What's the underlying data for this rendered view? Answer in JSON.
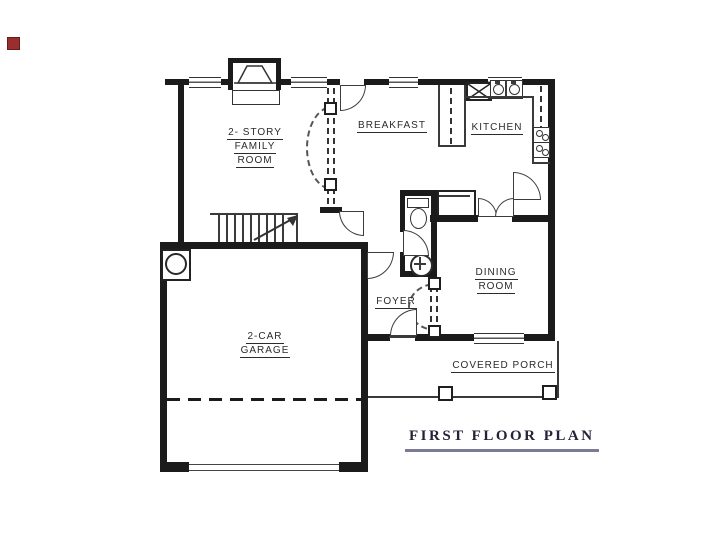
{
  "title": {
    "text": "FIRST FLOOR PLAN"
  },
  "rooms": {
    "family_room": {
      "line1": "2- STORY",
      "line2": "FAMILY",
      "line3": "ROOM"
    },
    "breakfast": {
      "label": "BREAKFAST"
    },
    "kitchen": {
      "label": "KITCHEN"
    },
    "dining_room": {
      "line1": "DINING",
      "line2": "ROOM"
    },
    "foyer": {
      "label": "FOYER"
    },
    "garage": {
      "line1": "2-CAR",
      "line2": "GARAGE"
    },
    "covered_porch": {
      "label": "COVERED PORCH"
    }
  },
  "colors": {
    "background": "#ffffff",
    "wall": "#1b1b1b",
    "line": "#3a3a3a",
    "title_text": "#23233a",
    "title_underline": "#7b7b94",
    "marker": "#992e2e"
  }
}
